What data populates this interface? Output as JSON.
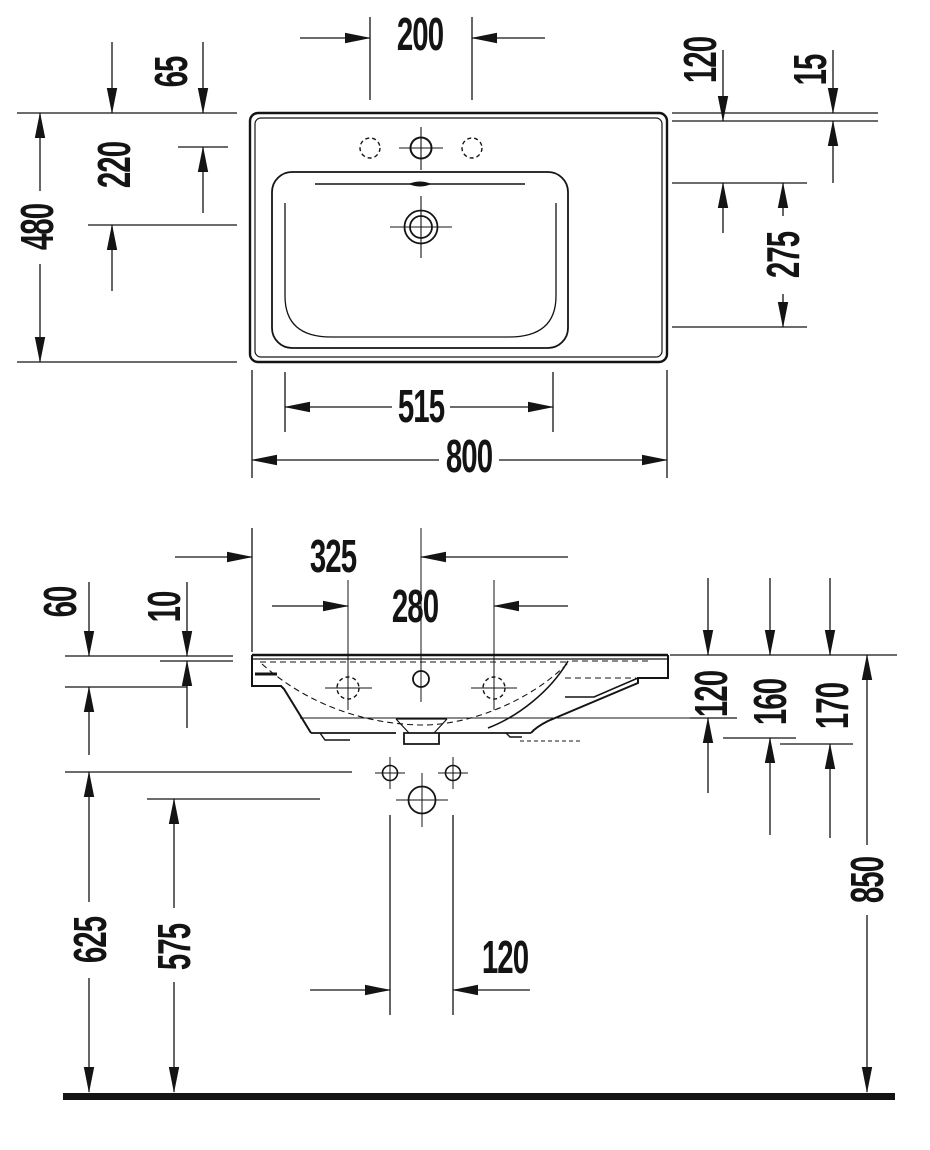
{
  "colors": {
    "ink": "#141414",
    "background": "#ffffff"
  },
  "dimensions": {
    "top_view": {
      "faucet_hole_spacing": "200",
      "rim_to_faucet_axis": "65",
      "rim_to_drain_axis": "220",
      "overall_depth": "480",
      "rear_edge_to_overflow": "120",
      "rear_edge_thickness": "15",
      "overflow_to_bowl_front": "275",
      "bowl_width": "515",
      "overall_width": "800"
    },
    "front_view": {
      "left_edge_to_faucet_axis": "325",
      "side_hole_spacing": "280",
      "apron_height": "60",
      "rim_thickness": "10",
      "top_to_rear_wall_bottom": "120",
      "top_to_outlet_flange": "160",
      "overall_body_height": "170",
      "rim_height_above_floor": "850",
      "fixing_hole_height": "625",
      "outlet_height": "575",
      "fixing_hole_spacing": "120"
    }
  }
}
